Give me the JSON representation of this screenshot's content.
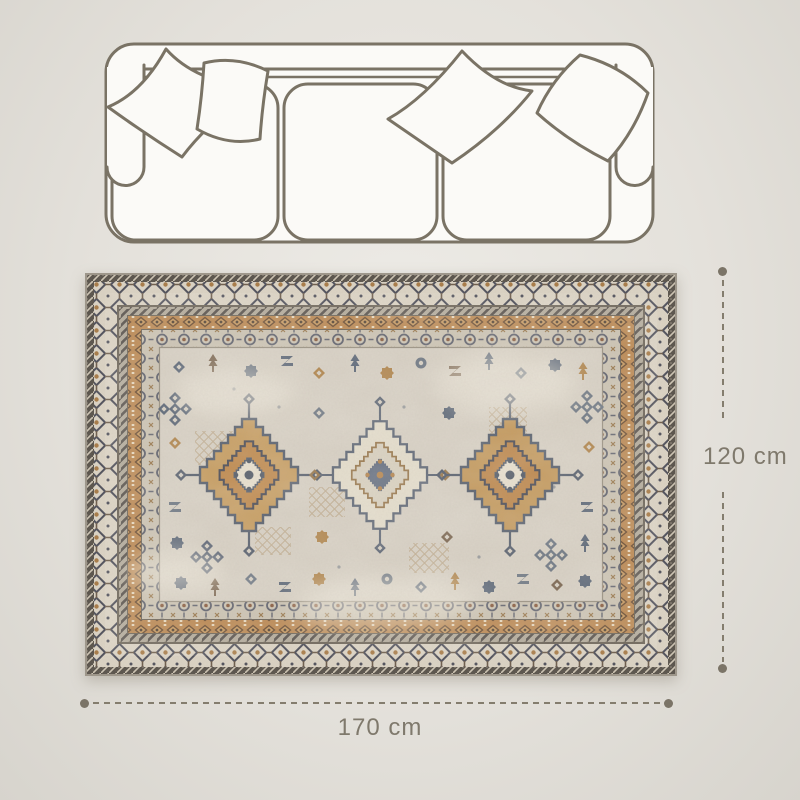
{
  "dimensions": {
    "width_label": "170 cm",
    "height_label": "120 cm"
  },
  "graphics": {
    "sofa_icon": "sofa-top-view-outline",
    "rug_image": "vintage-oriental-area-rug"
  },
  "palette": {
    "outline": "#7a7365",
    "dimension_line": "#847d6e",
    "dimension_text": "#7f796c",
    "background": "#e4e1db",
    "rug_field": "#d7d0c4",
    "rug_border_ivory": "#dcd4c5",
    "rug_rust": "#bc8a55",
    "rug_tan": "#c79e63",
    "rug_blue_gray": "#59616f"
  }
}
